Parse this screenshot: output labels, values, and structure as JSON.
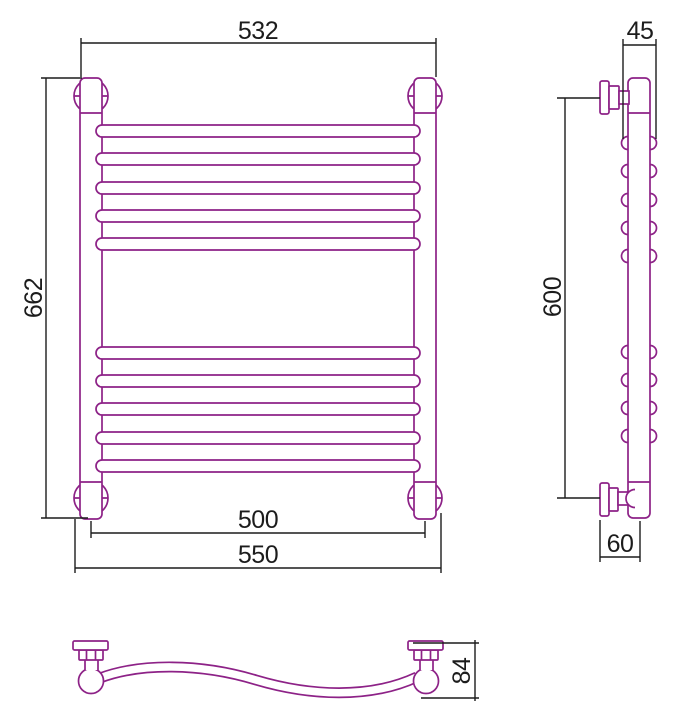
{
  "colors": {
    "product_line": "#8D2287",
    "dimension_line": "#1c1c1c",
    "background": "#ffffff"
  },
  "dimensions": {
    "overall_width": "532",
    "overall_height": "662",
    "axis_spacing": "500",
    "connection_spacing": "550",
    "side_width": "45",
    "bracket_spacing": "600",
    "wall_offset": "60",
    "depth": "84"
  }
}
